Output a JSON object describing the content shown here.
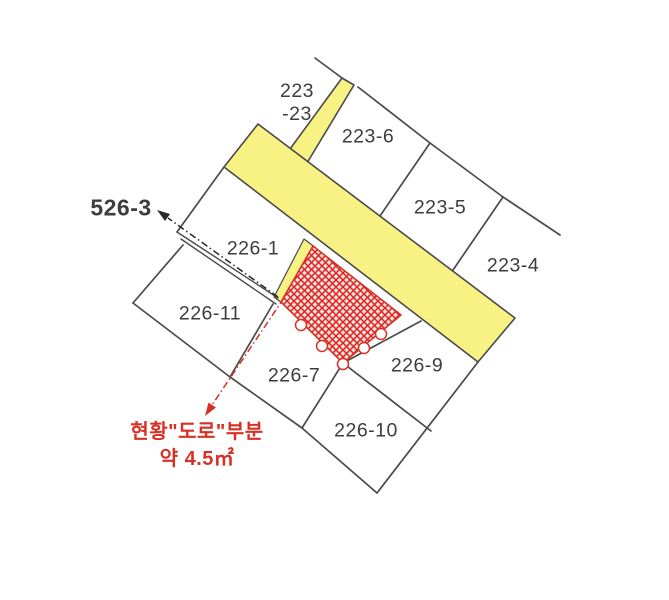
{
  "map": {
    "type": "cadastral-parcel-map",
    "parcels": {
      "p223_23": {
        "line1": "223",
        "line2": "-23"
      },
      "p223_6": {
        "label": "223-6"
      },
      "p223_5": {
        "label": "223-5"
      },
      "p223_4": {
        "label": "223-4"
      },
      "p226_1": {
        "label": "226-1"
      },
      "p226_11": {
        "label": "226-11"
      },
      "p226_7": {
        "label": "226-7"
      },
      "p226_9": {
        "label": "226-9"
      },
      "p226_10": {
        "label": "226-10"
      }
    },
    "annotations": {
      "p526_3": {
        "label": "526-3"
      },
      "road_note": {
        "line1": "현황\"도로\"부분",
        "line2": "약 4.5㎡"
      }
    },
    "colors": {
      "background": "#ffffff",
      "road_fill": "#f8f285",
      "road_outline": "#4a4a4a",
      "parcel_line": "#4a4a4a",
      "label_text": "#3d3d3d",
      "highlight_red": "#d93025",
      "note_text": "#d93025"
    }
  }
}
